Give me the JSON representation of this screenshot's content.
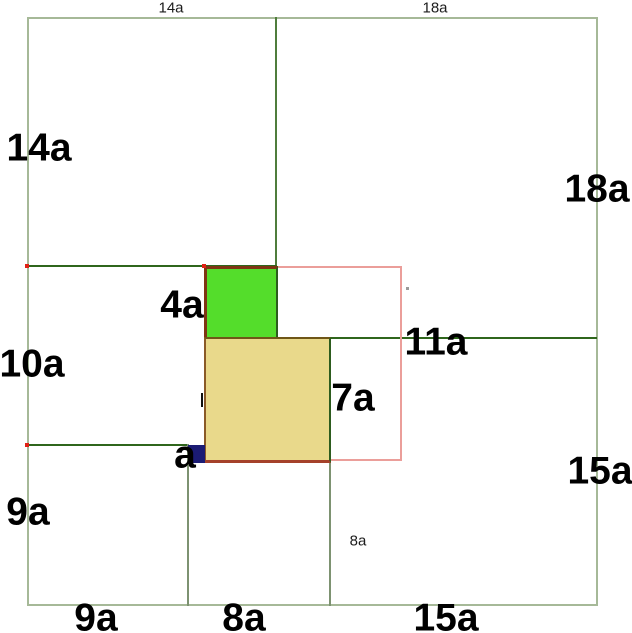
{
  "figure": {
    "outer_labels": {
      "top_left": "14a",
      "top_right": "18a",
      "left_upper": "14a",
      "left_middle": "10a",
      "left_lower": "9a",
      "right_upper": "18a",
      "right_lower": "15a",
      "bottom_left": "9a",
      "bottom_center": "8a",
      "bottom_right": "15a"
    },
    "inner_labels": {
      "green_square": "4a",
      "tan_square": "7a",
      "unit_square": "a",
      "pink_square": "11a",
      "small_8a": "8a"
    },
    "colors": {
      "outer_border": "#a6b998",
      "line_dark": "#2f661c",
      "line_mid": "#4f7d3c",
      "line_olive": "#7d9271",
      "green_fill": "#54dd2b",
      "tan_fill": "#e9d98b",
      "navy_fill": "#1b1b74",
      "pink_line": "#eb9e9a",
      "maroon": "#7e3513",
      "brown": "#8a5a28",
      "brown_red": "#a5412a",
      "olive_brown": "#6f5617",
      "dark_green_edge": "#2d5c1e",
      "red_dot": "#e02015",
      "label": "#000000"
    }
  }
}
